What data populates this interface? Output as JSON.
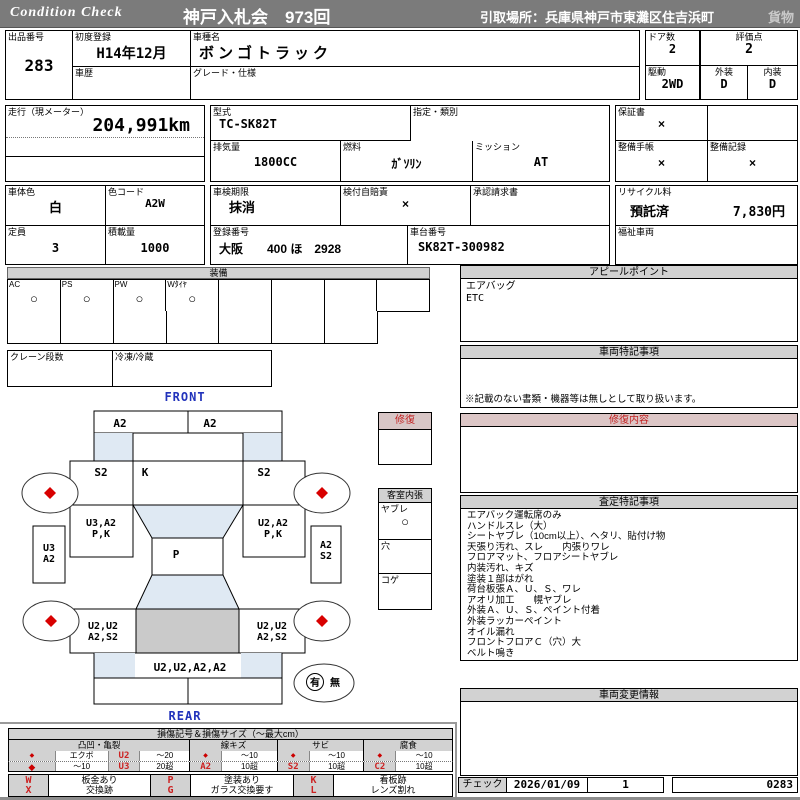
{
  "header": {
    "brand": "Condition  Check",
    "auction": "神戸入札会　973回",
    "pickup": "引取場所：兵庫県神戸市東灘区住吉浜町",
    "cargo": "貨物"
  },
  "info": {
    "lot_label": "出品番号",
    "lot": "283",
    "first_reg_label": "初度登録",
    "first_reg": "H14年12月",
    "history_label": "車歴",
    "history": "",
    "model_label": "車種名",
    "model": "ボンゴトラック",
    "grade_label": "グレード・仕様",
    "grade": "",
    "doors_label": "ドア数",
    "doors": "2",
    "drive_label": "駆動",
    "drive": "2WD",
    "score_label": "評価点",
    "score": "2",
    "exterior_label": "外装",
    "exterior": "D",
    "interior_label": "内装",
    "interior": "D",
    "odo_label": "走行（現メーター）",
    "odo": "204,991km",
    "type_label": "型式",
    "type": "TC-SK82T",
    "class_label": "指定・類別",
    "class": "",
    "disp_label": "排気量",
    "disp": "1800CC",
    "fuel_label": "燃料",
    "fuel": "ｶﾞｿﾘﾝ",
    "mission_label": "ミッション",
    "mission": "AT",
    "warranty_label": "保証書",
    "warranty": "×",
    "maint_book_label": "整備手帳",
    "maint_book": "×",
    "maint_rec_label": "整備記録",
    "maint_rec": "×",
    "color_label": "車体色",
    "color": "白",
    "color_code_label": "色コード",
    "color_code": "A2W",
    "capacity_label": "定員",
    "capacity": "3",
    "load_label": "積載量",
    "load": "1000",
    "shaken_label": "車検期限",
    "shaken": "抹消",
    "jibai_label": "検付自賠責",
    "jibai": "×",
    "approval_label": "承認請求書",
    "approval": "",
    "recycle_label": "リサイクル料",
    "recycle_status": "預託済",
    "recycle_fee": "7,830円",
    "reg_no_label": "登録番号",
    "reg_no": "大阪　　400 ほ　2928",
    "chassis_label": "車台番号",
    "chassis": "SK82T-300982",
    "welfare_label": "福祉車両",
    "welfare": ""
  },
  "equipment": {
    "title": "装備",
    "labels": [
      "AC",
      "PS",
      "PW",
      "Wﾀｲﾔ"
    ],
    "mark": "○",
    "crane_label": "クレーン段数",
    "reefer_label": "冷凍/冷蔵"
  },
  "appeal": {
    "title": "アピールポイント",
    "lines": [
      "エアバッグ",
      "ETC"
    ]
  },
  "vehicle_notes": {
    "title": "車両特記事項",
    "note": "※記載のない書類・機器等は無しとして取り扱います。"
  },
  "repair_content": {
    "title": "修復内容"
  },
  "assessment": {
    "title": "査定特記事項",
    "lines": [
      "エアバック運転席のみ",
      "ハンドルスレ（大）",
      "シートヤブレ（10cm以上）、ヘタリ、貼付け物",
      "天張り汚れ、スレ　　内張りワレ",
      "フロアマット、フロアシートヤブレ",
      "内装汚れ、キズ",
      "塗装１部はがれ",
      "荷台板張Ａ、Ｕ、Ｓ、ワレ",
      "アオリ加工　　幌ヤブレ",
      "外装Ａ、Ｕ、Ｓ、ペイント付着",
      "外装ラッカーペイント",
      "オイル漏れ",
      "フロントフロアＣ（穴）大",
      "ベルト鳴き"
    ]
  },
  "change_info": {
    "title": "車両変更情報"
  },
  "check": {
    "label": "チェック",
    "date": "2026/01/09",
    "count": "1",
    "number": "0283"
  },
  "repair_box": {
    "title": "修復"
  },
  "cabin_box": {
    "title": "客室内張",
    "rows": [
      {
        "label": "ヤブレ",
        "mark": "○"
      },
      {
        "label": "穴",
        "mark": ""
      },
      {
        "label": "コゲ",
        "mark": ""
      }
    ]
  },
  "diagram": {
    "front_label": "FRONT",
    "rear_label": "REAR",
    "panel_fl": "A2",
    "panel_fr": "A2",
    "fender_fl": "S2",
    "bonnet": "K",
    "fender_fr": "S2",
    "door_l1": "U3,A2",
    "door_l2": "P,K",
    "door_r1": "U2,A2",
    "door_r2": "P,K",
    "step_l1": "U3",
    "step_l2": "A2",
    "step_r1": "A2",
    "step_r2": "S2",
    "cab_back": "P",
    "bed_l1": "U2,U2",
    "bed_l2": "A2,S2",
    "bed_r1": "U2,U2",
    "bed_r2": "A2,S2",
    "rear_gate": "U2,U2,A2,A2",
    "spare_yes": "有",
    "spare_no": "無"
  },
  "legend": {
    "title": "損傷記号＆損傷サイズ（～最大cm）",
    "groups": [
      "凸凹・亀裂",
      "線キズ",
      "サビ",
      "腐食"
    ],
    "row1": [
      "◆",
      "エクボ",
      "U2",
      "～20",
      "◆",
      "～10",
      "◆",
      "～10",
      "◆",
      "～10"
    ],
    "row2": [
      "◆",
      "～10",
      "U3",
      "20超",
      "A2",
      "10超",
      "S2",
      "10超",
      "C2",
      "10超"
    ],
    "codes1": [
      "W",
      "板金あり",
      "P",
      "塗装あり",
      "K",
      "看板跡"
    ],
    "codes2": [
      "X",
      "交換跡",
      "G",
      "ガラス交換要す",
      "L",
      "レンズ割れ"
    ]
  }
}
